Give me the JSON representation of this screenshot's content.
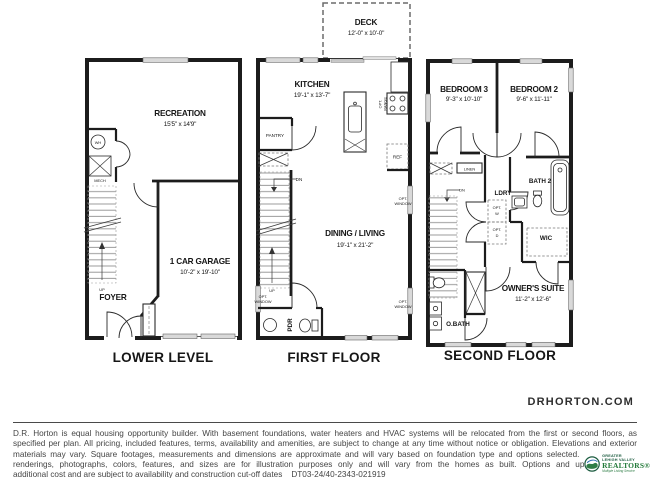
{
  "header": {
    "website": "DRHORTON.COM"
  },
  "labels": {
    "opt": "OPT.",
    "window": "WINDOW",
    "range": "RANGE",
    "ref": "REF",
    "dn": "DN",
    "up": "UP",
    "wh": "WH",
    "mech": "MECH",
    "pantry": "PANTRY",
    "linen": "LINEN",
    "washer": "W",
    "dryer": "D"
  },
  "plans": {
    "lower": {
      "label": "LOWER LEVEL",
      "recreation": "RECREATION",
      "recreation_dims": "15'5\" x 14'9\"",
      "garage": "1 CAR GARAGE",
      "garage_dims": "10'-2\" x 19'-10\"",
      "foyer": "FOYER"
    },
    "first": {
      "label": "FIRST FLOOR",
      "deck": "DECK",
      "deck_dims": "12'-0\" x 10'-0\"",
      "kitchen": "KITCHEN",
      "kitchen_dims": "19'-1\" x 13'-7\"",
      "dining": "DINING / LIVING",
      "dining_dims": "19'-1\" x 21'-2\"",
      "pdr": "PDR"
    },
    "second": {
      "label": "SECOND FLOOR",
      "bedroom3": "BEDROOM 3",
      "bedroom3_dims": "9'-3\" x 10'-10\"",
      "bedroom2": "BEDROOM 2",
      "bedroom2_dims": "9'-6\" x 11'-11\"",
      "bath2": "BATH 2",
      "ldry": "LDRY",
      "wic": "WIC",
      "owners": "OWNER'S SUITE",
      "owners_dims": "11'-2\" x 12'-6\"",
      "obath": "O.BATH"
    }
  },
  "footer": {
    "disclaimer_lines": [
      "D.R. Horton is equal housing opportunity builder. With basement foundations, water heaters and HVAC systems will be relocated from the first or second floors, as",
      "specified per plan. All pricing, included features, terms, availability and amenities, are subject to change at any time without notice or obligation. Elevations and exterior",
      "materials may vary. Square footages, measurements and dimensions are approximate and will vary based on foundation type and options selected. Pictures, artist",
      "renderings, photographs, colors, features, and sizes are for illustration purposes only and will vary from the homes as built. Options and upgrades are a",
      "additional cost and are subject to availability and construction cut-off dates    DT03-24/40-2343-021919"
    ]
  },
  "logo": {
    "org_line1": "GREATER",
    "org_line2": "LEHIGH VALLEY",
    "org_line3": "REALTORS®",
    "tagline": "Multiple Listing Service"
  },
  "colors": {
    "wall": "#1c1c1c",
    "logo_green": "#237a3a",
    "logo_dark_green": "#1c5c40",
    "logo_blue": "#2b6cb0"
  }
}
